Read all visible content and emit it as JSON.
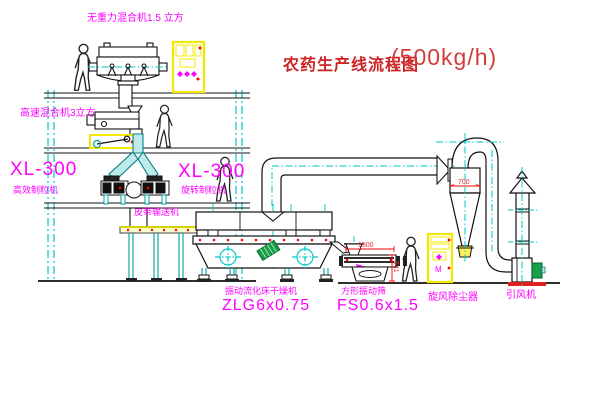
{
  "title": {
    "name": "农药生产线流程图",
    "capacity": "(500kg/h)"
  },
  "labels": {
    "gravity_mixer": "无重力混合机1.5 立方",
    "high_speed_mixer": "高速混合机3立方",
    "granulator_left_model": "XL-300",
    "granulator_left_name": "高效制粒机",
    "granulator_right_model": "XL-300",
    "granulator_right_name": "旋转制粒机",
    "belt_conveyor": "皮带输送机",
    "dryer_name": "振动流化床干燥机",
    "dryer_model": "ZLG6x0.75",
    "sieve_name": "方形振动筛",
    "sieve_model": "FS0.6x1.5",
    "cyclone": "旋风除尘器",
    "fan": "引风机"
  },
  "dimensions": {
    "cyclone_width": "700",
    "sieve_length": "1500",
    "sieve_height": "541"
  },
  "annotations": {
    "cabinet_motor_mark": "M"
  },
  "colors": {
    "line_cyan": "#00c8c8",
    "text_magenta": "#ff00ff",
    "title_red": "#cc2222",
    "highlight_yellow": "#ffff00",
    "accent_red": "#ff0000",
    "motor_green": "#18a048"
  }
}
